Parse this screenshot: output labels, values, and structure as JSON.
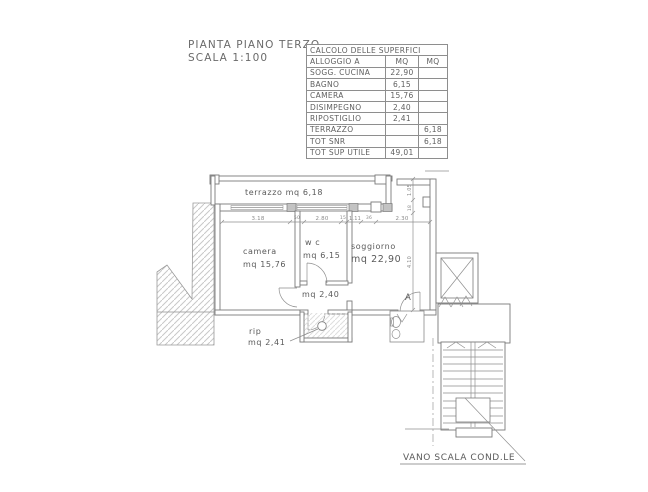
{
  "title_block": {
    "line1": "PIANTA PIANO TERZO",
    "line2": "SCALA 1:100"
  },
  "table": {
    "title": "CALCOLO DELLE SUPERFICI",
    "header": {
      "name": "ALLOGGIO A",
      "col1": "MQ",
      "col2": "MQ"
    },
    "rows": [
      {
        "name": "SOGG. CUCINA",
        "mq1": "22,90",
        "mq2": ""
      },
      {
        "name": "BAGNO",
        "mq1": "6,15",
        "mq2": ""
      },
      {
        "name": "CAMERA",
        "mq1": "15,76",
        "mq2": ""
      },
      {
        "name": "DISIMPEGNO",
        "mq1": "2,40",
        "mq2": ""
      },
      {
        "name": "RIPOSTIGLIO",
        "mq1": "2,41",
        "mq2": ""
      },
      {
        "name": "TERRAZZO",
        "mq1": "",
        "mq2": "6,18"
      },
      {
        "name": "TOT SNR",
        "mq1": "",
        "mq2": "6,18"
      },
      {
        "name": "TOT SUP UTILE",
        "mq1": "49,01",
        "mq2": ""
      }
    ]
  },
  "plan": {
    "rooms": {
      "terrazzo": "terrazzo mq 6,18",
      "camera_line1": "camera",
      "camera_line2": "mq 15,76",
      "wc_line1": "w c",
      "wc_line2": "mq 6,15",
      "soggiorno_line1": "soggiorno",
      "soggiorno_line2": "mq 22,90",
      "disimpegno": "mq 2,40",
      "rip_line1": "rip",
      "rip_line2": "mq 2,41",
      "entrance": "A"
    },
    "dimensions": {
      "h": [
        "3.18",
        "50",
        "2.80",
        "15",
        "1.11",
        "36",
        "2.30"
      ],
      "v": [
        "1.05",
        "18",
        "4.10"
      ]
    },
    "callout": "VANO SCALA COND.LE"
  },
  "colors": {
    "line": "#7a7a7a",
    "line_light": "#8f8f8f",
    "text": "#5a5a5a",
    "dim_text": "#8a8a8a",
    "hatch": "#c8c8c8",
    "pier_fill": "#c3c3c3",
    "background": "#ffffff"
  }
}
